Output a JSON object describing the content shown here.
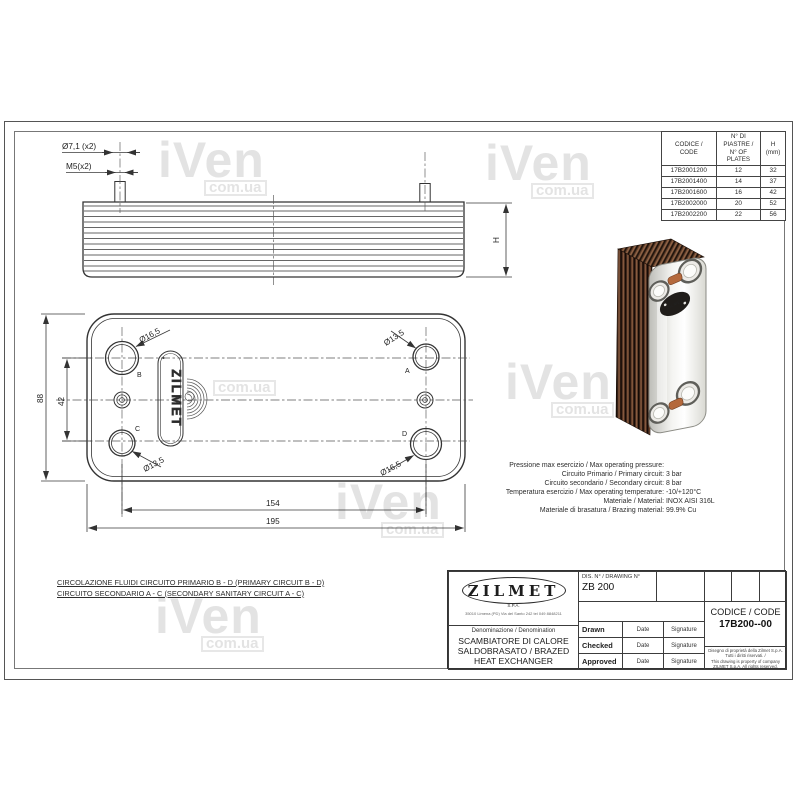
{
  "watermark": {
    "big": "iVen",
    "small": "com.ua"
  },
  "parts_table": {
    "headers": [
      {
        "l1": "CODICE /",
        "l2": "CODE"
      },
      {
        "l1": "N° DI PIASTRE /",
        "l2": "N° OF PLATES"
      },
      {
        "l1": "H",
        "l2": "(mm)"
      }
    ],
    "rows": [
      [
        "17B2001200",
        "12",
        "32"
      ],
      [
        "17B2001400",
        "14",
        "37"
      ],
      [
        "17B2001600",
        "16",
        "42"
      ],
      [
        "17B2002000",
        "20",
        "52"
      ],
      [
        "17B2002200",
        "22",
        "56"
      ]
    ]
  },
  "side_view": {
    "dim_hole": "Ø7,1 (x2)",
    "dim_thread": "M5(x2)",
    "dim_height": "H"
  },
  "front_view": {
    "logo_vertical": "ZILMET",
    "dia_top_left": "Ø16,5",
    "dia_top_right": "Ø13,5",
    "dia_bottom_left": "Ø13,5",
    "dia_bottom_right": "Ø16,5",
    "port_a": "A",
    "port_b": "B",
    "port_c": "C",
    "port_d": "D",
    "dim_height_total": "88",
    "dim_height_ports": "42",
    "dim_width_ports": "154",
    "dim_width_total": "195"
  },
  "specs": {
    "l1": {
      "label": "Pressione max esercizio / Max operating pressure:",
      "value": ""
    },
    "l2": {
      "label": "Circuito Primario / Primary circuit:",
      "value": "3 bar"
    },
    "l3": {
      "label": "Circuito secondario / Secondary circuit:",
      "value": "8 bar"
    },
    "l4": {
      "label": "Temperatura esercizio / Max operating temperature:",
      "value": "-10/+120°C"
    },
    "l5": {
      "label": "Materiale / Material:",
      "value": "INOX AISI 316L"
    },
    "l6": {
      "label": "Materiale di brasatura / Brazing material:",
      "value": "99.9% Cu"
    }
  },
  "notes": {
    "line1": "CIRCOLAZIONE FLUIDI CIRCUITO PRIMARIO B - D (PRIMARY CIRCUIT B - D)",
    "line2": "CIRCUITO SECONDARIO A - C (SECONDARY SANITARY CIRCUIT A - C)"
  },
  "title_block": {
    "logo": "ZILMET",
    "logo_sub": "S.P.A.",
    "logo_address": "35010 Limena (PD) Via del Santo 242 tel 049 8848211",
    "denomination_label": "Denominazione / Denomination",
    "denomination": "SCAMBIATORE DI CALORE SALDOBRASATO / BRAZED HEAT EXCHANGER",
    "drawing_no_label": "DIS. N° / DRAWING N°",
    "drawing_no": "ZB 200",
    "code_label": "CODICE / CODE",
    "code": "17B200--00",
    "row_drawn": "Drawn",
    "row_checked": "Checked",
    "row_approved": "Approved",
    "date_label": "Date",
    "signature_label": "Signature",
    "copyright_it": "Disegno di proprietà della Zilmet S.p.A. Tutti i diritti riservati. /",
    "copyright_en": "This drawing is property of company ZILMET S.p.A. All rights reserved."
  }
}
